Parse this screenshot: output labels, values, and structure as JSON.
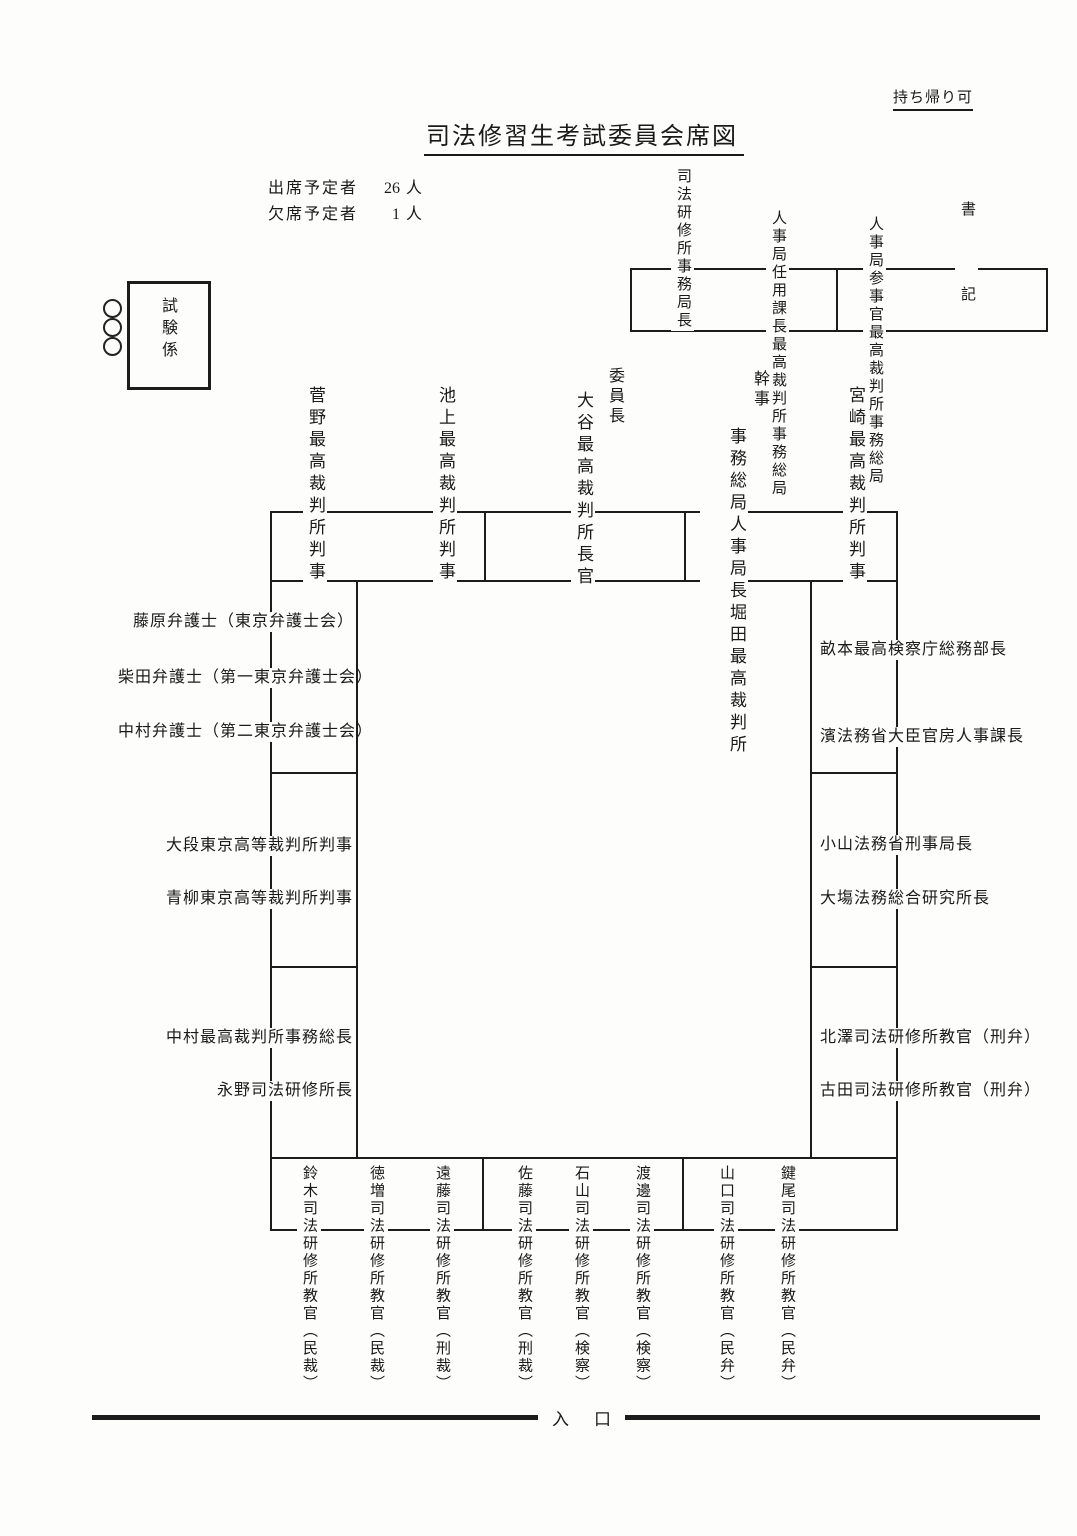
{
  "header": {
    "note_top_right": "持ち帰り可",
    "title": "司法修習生考試委員会席図",
    "attendance": {
      "rows": [
        {
          "label": "出席予定者",
          "value": "26",
          "unit": "人"
        },
        {
          "label": "欠席予定者",
          "value": "1",
          "unit": "人"
        }
      ]
    }
  },
  "exam_staff": {
    "label": "試験係"
  },
  "secretariat_desk": {
    "seats": [
      {
        "lines": [
          "司法研修所事務局長"
        ]
      },
      {
        "lines": [
          "最高裁判所事務総局",
          "人事局任用課長"
        ]
      },
      {
        "lines": [
          "最高裁判所事務総局",
          "人事局参事官"
        ]
      },
      {
        "lines": [
          "書",
          "記"
        ]
      }
    ]
  },
  "main_table": {
    "top_seats": [
      {
        "name": "菅野最高裁判所判事"
      },
      {
        "name": "池上最高裁判所判事"
      },
      {
        "role": "委員長",
        "name": "大谷最高裁判所長官"
      },
      {
        "role": "幹事",
        "lines": [
          "堀田最高裁判所",
          "事務総局人事局長"
        ]
      },
      {
        "name": "宮崎最高裁判所判事"
      }
    ],
    "left_seats": [
      {
        "name": "藤原弁護士（東京弁護士会）"
      },
      {
        "name": "柴田弁護士（第一東京弁護士会）"
      },
      {
        "name": "中村弁護士（第二東京弁護士会）"
      },
      {
        "name": "大段東京高等裁判所判事"
      },
      {
        "name": "青柳東京高等裁判所判事"
      },
      {
        "name": "中村最高裁判所事務総長"
      },
      {
        "name": "永野司法研修所長"
      }
    ],
    "right_seats": [
      {
        "name": "畝本最高検察庁総務部長"
      },
      {
        "name": "濱法務省大臣官房人事課長"
      },
      {
        "name": "小山法務省刑事局長"
      },
      {
        "name": "大塲法務総合研究所長"
      },
      {
        "name": "北澤司法研修所教官（刑弁）"
      },
      {
        "name": "古田司法研修所教官（刑弁）"
      }
    ],
    "bottom_seats": [
      {
        "name": "鈴木司法研修所教官（民裁）"
      },
      {
        "name": "徳増司法研修所教官（民裁）"
      },
      {
        "name": "遠藤司法研修所教官（刑裁）"
      },
      {
        "name": "佐藤司法研修所教官（刑裁）"
      },
      {
        "name": "石山司法研修所教官（検察）"
      },
      {
        "name": "渡邊司法研修所教官（検察）"
      },
      {
        "name": "山口司法研修所教官（民弁）"
      },
      {
        "name": "鍵尾司法研修所教官（民弁）"
      }
    ]
  },
  "entrance": {
    "label": "入　口"
  }
}
